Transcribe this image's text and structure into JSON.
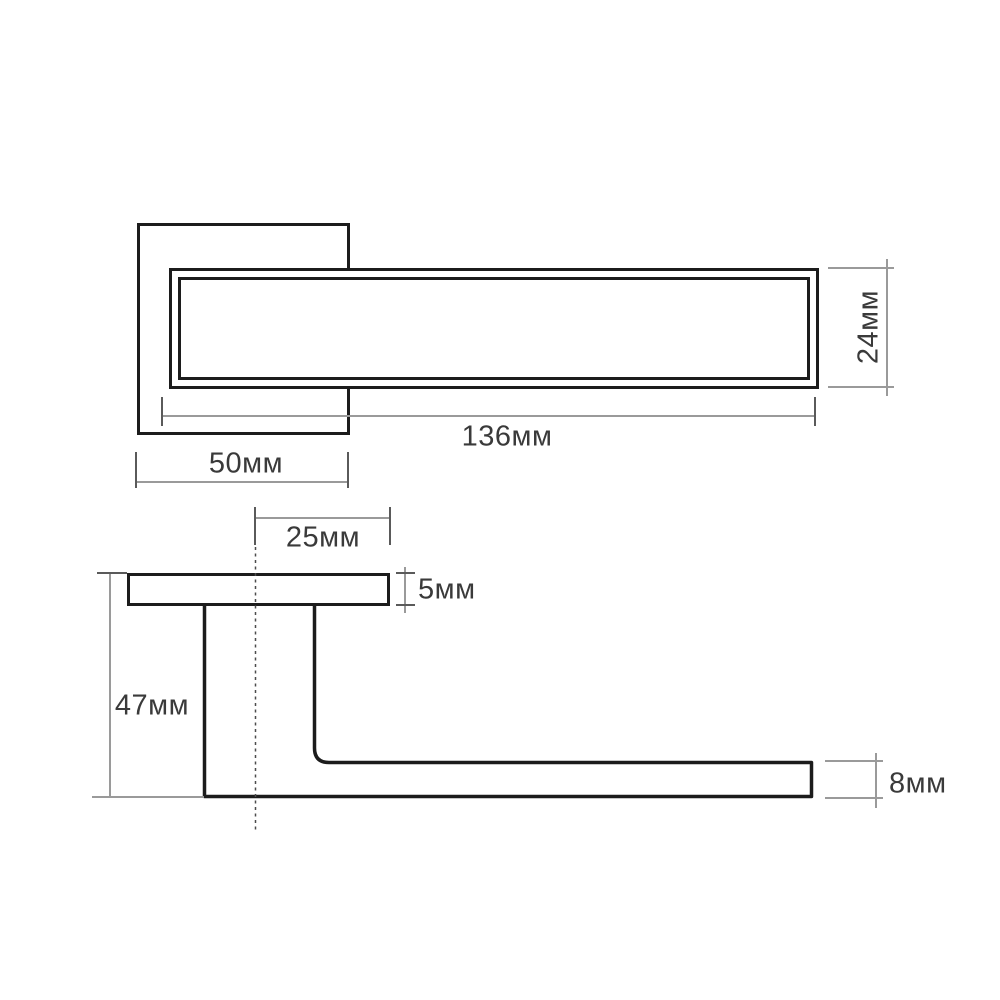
{
  "drawing": {
    "kind": "door-lever-handle-dimension-drawing",
    "units": "мм"
  },
  "colors": {
    "outline": "#1c1c1c",
    "dim_line": "#9a9a9a",
    "tick": "#5a5a5a",
    "label": "#3a3a3a",
    "centerline": "#4c4c4c",
    "background": "#ffffff"
  },
  "dimensions": {
    "top_view": {
      "lever_length": "136мм",
      "rose_width": "50мм",
      "lever_height": "24мм"
    },
    "side_view": {
      "center_offset": "25мм",
      "rose_thickness": "5мм",
      "handle_depth": "47мм",
      "lever_thickness": "8мм"
    }
  }
}
